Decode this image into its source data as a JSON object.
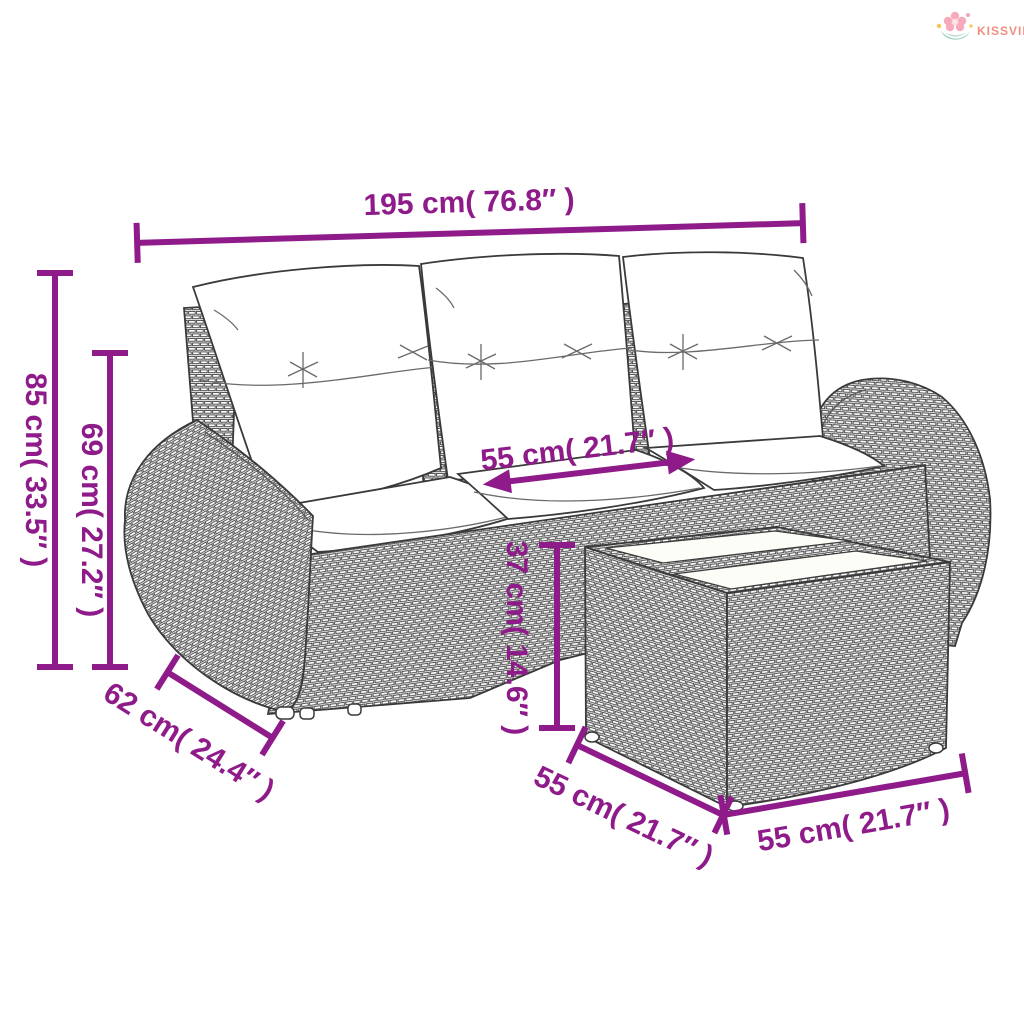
{
  "logo": {
    "brand": "KISSVILÁG"
  },
  "diagram": {
    "subject": "poly-rattan garden sofa set with cushions and glass-top ottoman table",
    "accent_color": "#8e1b89",
    "line_color": "#3a3a3a",
    "dimensions": {
      "overall_width": "195 cm( 76.8″ )",
      "overall_height": "85 cm( 33.5″ )",
      "back_height": "69 cm( 27.2″ )",
      "seat_width": "55 cm( 21.7″ )",
      "table_height": "37 cm( 14.6″ )",
      "arm_depth": "62 cm( 24.4″ )",
      "table_depth": "55 cm( 21.7″ )",
      "table_width": "55 cm( 21.7″ )"
    }
  }
}
